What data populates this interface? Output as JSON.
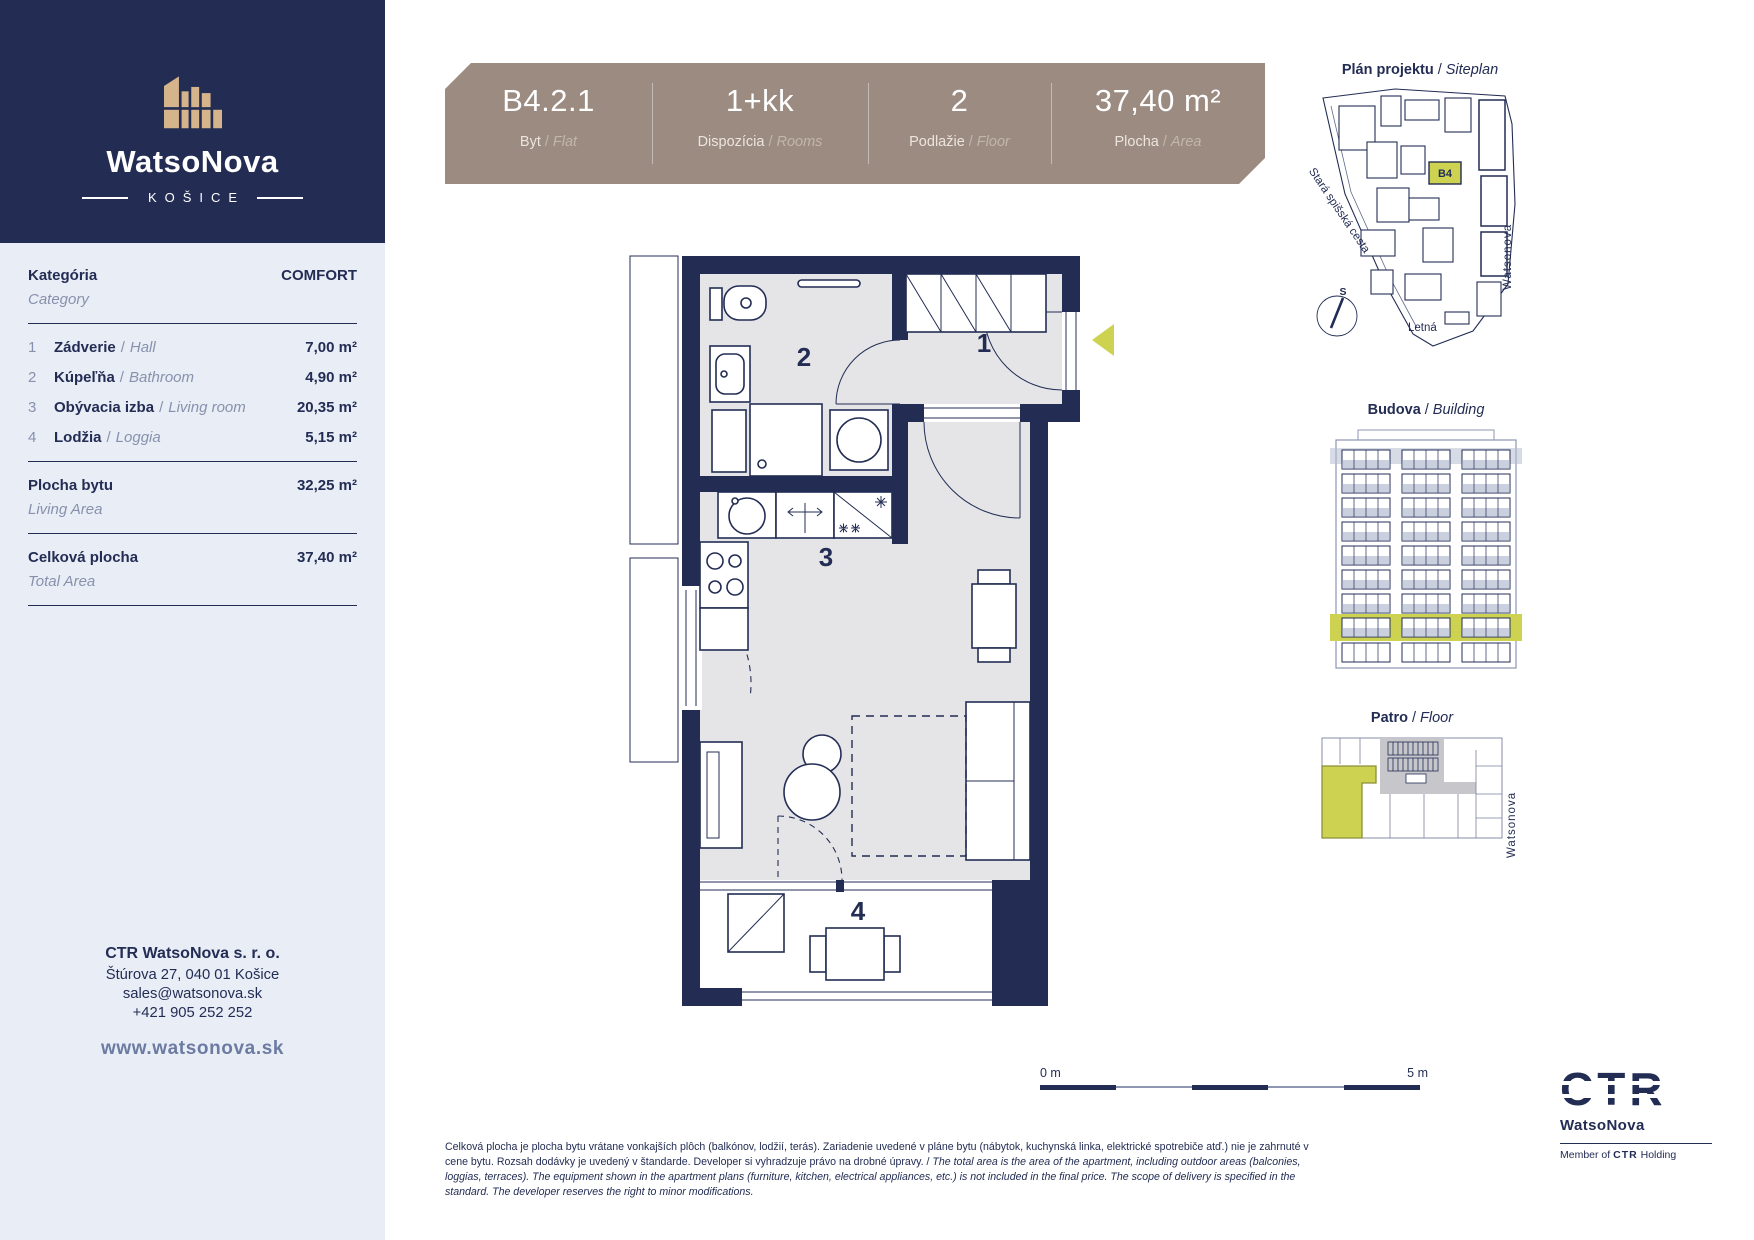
{
  "common": {
    "slash": "/"
  },
  "colors": {
    "navy": "#232d54",
    "taupe": "#9b8b81",
    "accent": "#cdd350",
    "sidebar_bg": "#e9edf6",
    "floor_gray": "#e5e5e8",
    "muted": "#8791ac"
  },
  "brand": {
    "name": "WatsoNova",
    "city": "KOŠICE"
  },
  "header": {
    "flat": {
      "value": "B4.2.1",
      "label_sk": "Byt",
      "label_en": "Flat"
    },
    "rooms": {
      "value": "1+kk",
      "label_sk": "Dispozícia",
      "label_en": "Rooms"
    },
    "floor": {
      "value": "2",
      "label_sk": "Podlažie",
      "label_en": "Floor"
    },
    "area": {
      "value": "37,40 m²",
      "label_sk": "Plocha",
      "label_en": "Area"
    }
  },
  "sidebar": {
    "category": {
      "label_sk": "Kategória",
      "label_en": "Category",
      "value": "COMFORT"
    },
    "rooms": [
      {
        "num": "1",
        "name_sk": "Zádverie",
        "name_en": "Hall",
        "area": "7,00 m²"
      },
      {
        "num": "2",
        "name_sk": "Kúpeľňa",
        "name_en": "Bathroom",
        "area": "4,90 m²"
      },
      {
        "num": "3",
        "name_sk": "Obývacia izba",
        "name_en": "Living room",
        "area": "20,35 m²"
      },
      {
        "num": "4",
        "name_sk": "Lodžia",
        "name_en": "Loggia",
        "area": "5,15 m²"
      }
    ],
    "living_area": {
      "label_sk": "Plocha bytu",
      "label_en": "Living Area",
      "value": "32,25 m²"
    },
    "total_area": {
      "label_sk": "Celková plocha",
      "label_en": "Total Area",
      "value": "37,40 m²"
    },
    "contact": {
      "company": "CTR WatsoNova s. r. o.",
      "address": "Štúrova 27, 040 01 Košice",
      "email": "sales@watsonova.sk",
      "phone": "+421 905 252 252",
      "website": "www.watsonova.sk"
    }
  },
  "floorplan": {
    "room1": "1",
    "room2": "2",
    "room3": "3",
    "room4": "4",
    "scale_start": "0 m",
    "scale_end": "5 m"
  },
  "siteplan": {
    "title_sk": "Plán projektu",
    "title_en": "Siteplan",
    "unit": "B4",
    "street_left": "Stará spišská cesta",
    "street_right": "Watsonova",
    "street_bottom": "Letná",
    "compass": "S"
  },
  "building": {
    "title_sk": "Budova",
    "title_en": "Building"
  },
  "floorplate": {
    "title_sk": "Patro",
    "title_en": "Floor",
    "street": "Watsonova"
  },
  "footer": {
    "disclaimer_sk": "Celková plocha je plocha bytu vrátane vonkajších plôch (balkónov, lodžií, terás). Zariadenie uvedené v pláne bytu (nábytok, kuchynská linka, elektrické spotrebiče atď.) nie je zahrnuté v cene bytu. Rozsah dodávky je uvedený v štandarde. Developer si vyhradzuje právo na drobné úpravy. / ",
    "disclaimer_en": "The total area is the area of the apartment, including outdoor areas (balconies, loggias, terraces). The equipment shown in the apartment plans (furniture, kitchen, electrical appliances, etc.) is not included in the final price. The scope of delivery is specified in the standard. The developer reserves the right to minor modifications.",
    "logo_text": "CTR",
    "logo_sub": "WatsoNova",
    "member_prefix": "Member of",
    "member_brand": "CTR",
    "member_suffix": "Holding"
  }
}
